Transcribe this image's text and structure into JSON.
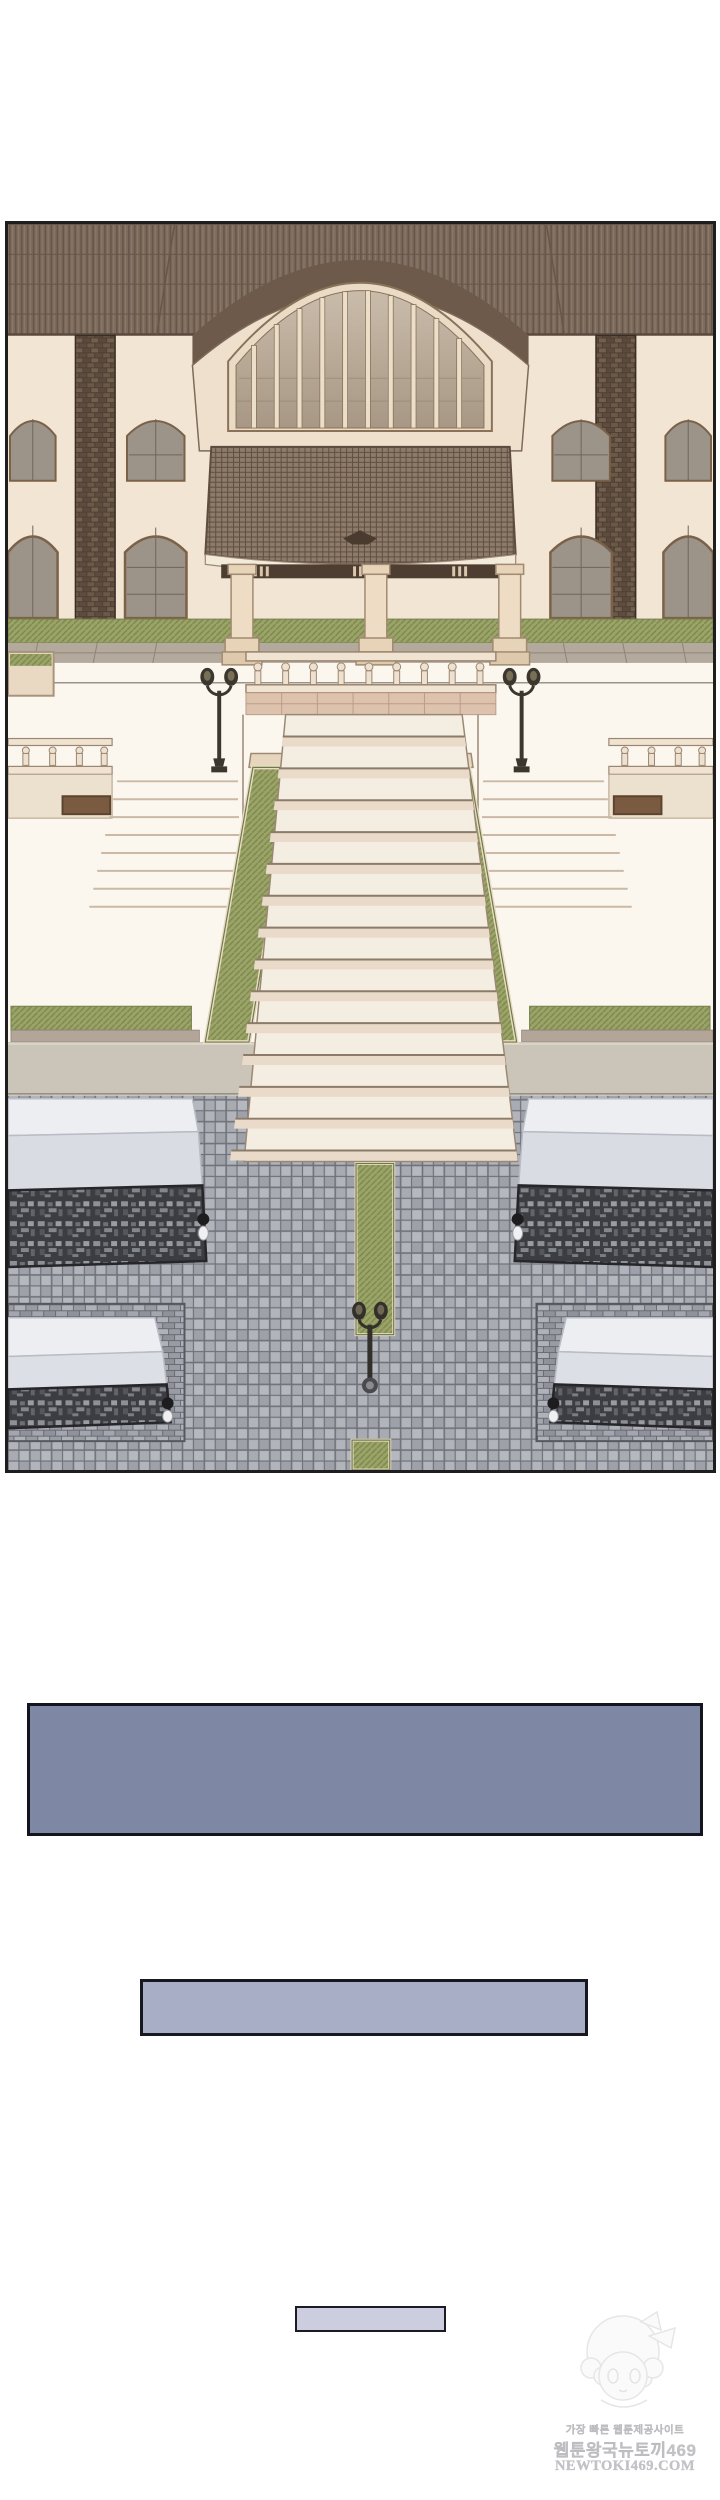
{
  "panel": {
    "label": "courtyard-illustration",
    "palette": {
      "panel_border": "#1e1e1e",
      "roof_brown": "#7d6b5d",
      "wall_cream": "#f2e5d3",
      "brick_dark": "#4f3f34",
      "hedge_green": "#9aa466",
      "ramp_green": "#99a362",
      "stair_marble": "#f4ede1",
      "plaza_tile_gray": "#a9abb3",
      "lattice_dark": "#3c3d41",
      "marble_white": "#eceef2",
      "lamp_iron": "#3b362e"
    }
  },
  "boxes": {
    "large": {
      "fill": "#7e87a4",
      "border": "#14141d"
    },
    "medium": {
      "fill": "#a8aec5",
      "border": "#17171f"
    },
    "small": {
      "fill": "#cccdde",
      "border": "#1b1b26"
    }
  },
  "watermark": {
    "line1": "가장 빠른 웹툰제공사이트",
    "line2": "웹툰왕국뉴토끼469",
    "line3": "NEWTOKI469.COM",
    "text_color": "#c3c3c7"
  }
}
